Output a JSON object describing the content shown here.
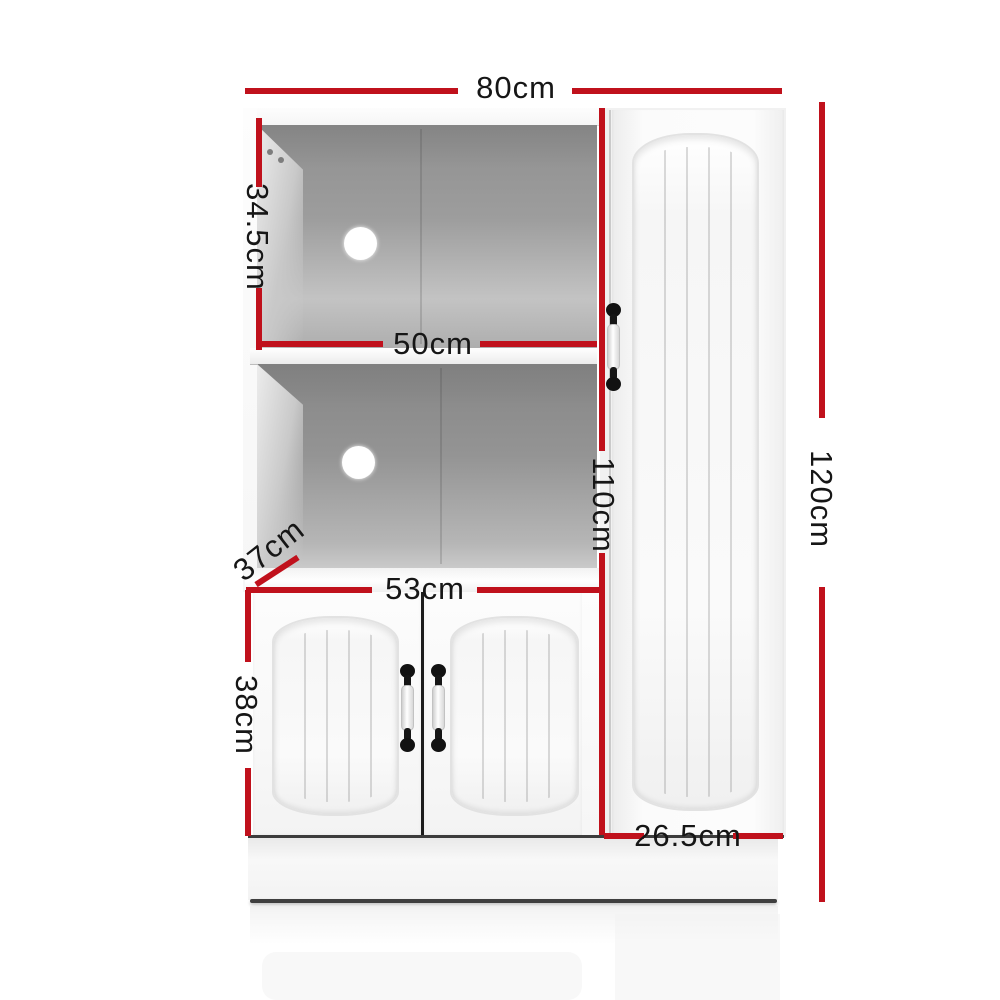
{
  "meta": {
    "diagram_type": "furniture-dimension-diagram",
    "subject": "White buffet sideboard cabinet with two open shelves, double lower doors and a tall side door",
    "background": "#ffffff",
    "accent_color": "#c0111c",
    "text_color": "#161616",
    "unit": "cm"
  },
  "labels": {
    "top_width": "80cm",
    "upper_shelf_height": "34.5cm",
    "shelf_interior_width": "50cm",
    "left_section_height": "110cm",
    "overall_height": "120cm",
    "depth": "37cm",
    "lower_section_width": "53cm",
    "lower_door_height": "38cm",
    "tall_door_width": "26.5cm"
  }
}
